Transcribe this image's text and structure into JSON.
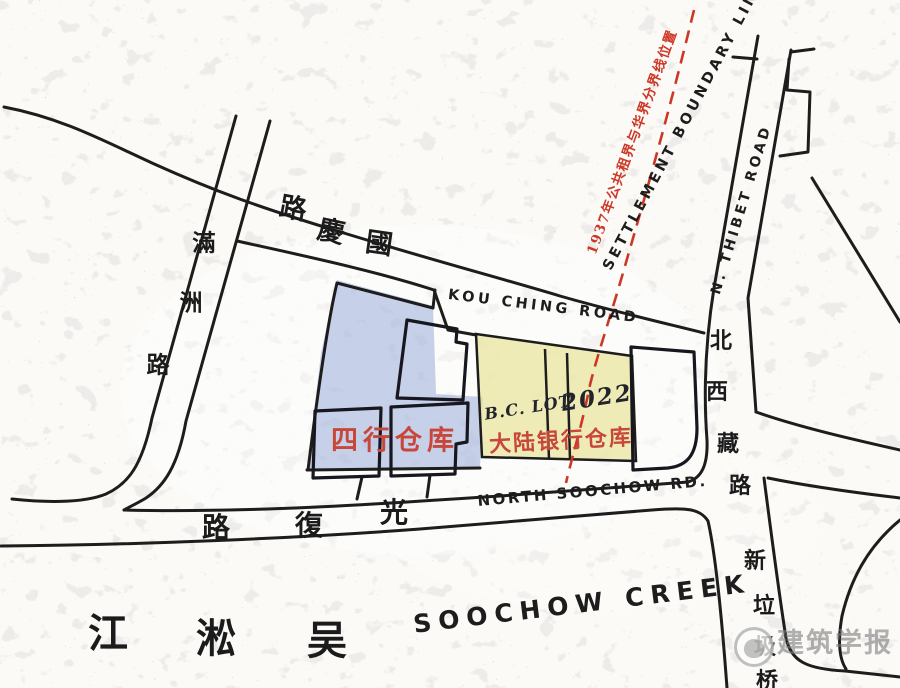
{
  "colors": {
    "paper": "#fbfaf7",
    "ink": "#1d1d1d",
    "sihang_overlay_blue": "#8fa3d6",
    "dalu_overlay_yellow": "#e9e49c",
    "boundary_red": "#cd3726",
    "site_label_red": "#c8473a",
    "watermark_gray": "#7d7d7d"
  },
  "boundary": {
    "label_cn": "1937年公共租界与华界分界线位置",
    "label_en": "SETTLEMENT BOUNDARY LINE"
  },
  "roads": {
    "thibet": "N. THIBET ROAD",
    "kou_ching": "KOU CHING ROAD",
    "north_soochow": "NORTH SOOCHOW RD.",
    "guoqing_chars": [
      "路",
      "慶",
      "國"
    ],
    "guangfu_chars": [
      "路",
      "復",
      "光"
    ],
    "manchuria_chars": [
      "滿",
      "洲",
      "路"
    ],
    "tibet_cn_chars": [
      "北",
      "西",
      "藏",
      "路"
    ],
    "bridge_chars": [
      "新",
      "垃",
      "圾",
      "桥"
    ]
  },
  "creek": {
    "label_en": "SOOCHOW CREEK",
    "chars": [
      "江",
      "淞",
      "吴"
    ]
  },
  "sites": {
    "sihang_label": "四行仓库",
    "dalu_label": "大陆银行仓库",
    "lot_prefix": "B.C. LOT",
    "lot_number": "2022"
  },
  "watermark": {
    "text": "建筑学报"
  }
}
